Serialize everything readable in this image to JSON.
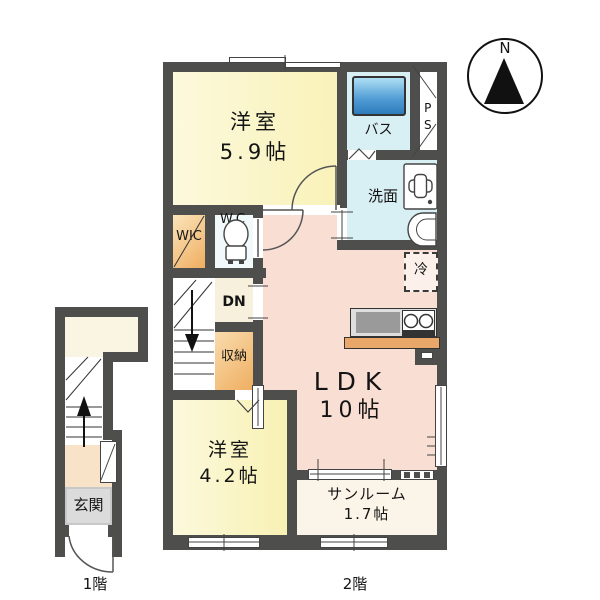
{
  "title": "apartment-floor-plan",
  "compass": {
    "north_label": "N"
  },
  "floors": {
    "first": "1階",
    "second": "2階"
  },
  "labels": {
    "room59_name": "洋室",
    "room59_size": "5.9帖",
    "bath": "バス",
    "ps": "PS",
    "senmen": "洗面",
    "wic": "WIC",
    "wc": "WC",
    "dn": "DN",
    "shuno": "収納",
    "rei": "冷",
    "ldk_name": "LDK",
    "ldk_size": "10帖",
    "room42_name": "洋室",
    "room42_size": "4.2帖",
    "sunroom_name": "サンルーム",
    "sunroom_size": "1.7帖",
    "genkan": "玄関"
  },
  "colors": {
    "wall": "#4e4e4c",
    "room_yellow": "#faf5c6",
    "room_cyan": "#d8f0f3",
    "room_pink": "#f9ded4",
    "closet_orange": "#f0b468",
    "hall_cream": "#f6f0dc",
    "sunroom_ivory": "#fbf4e8",
    "genkan_gray": "#c8c8c8",
    "hall1f_peach": "#f8e3c9",
    "bathtub_blue": "#4493ce",
    "kitchen_counter_wood": "#e9a869"
  }
}
